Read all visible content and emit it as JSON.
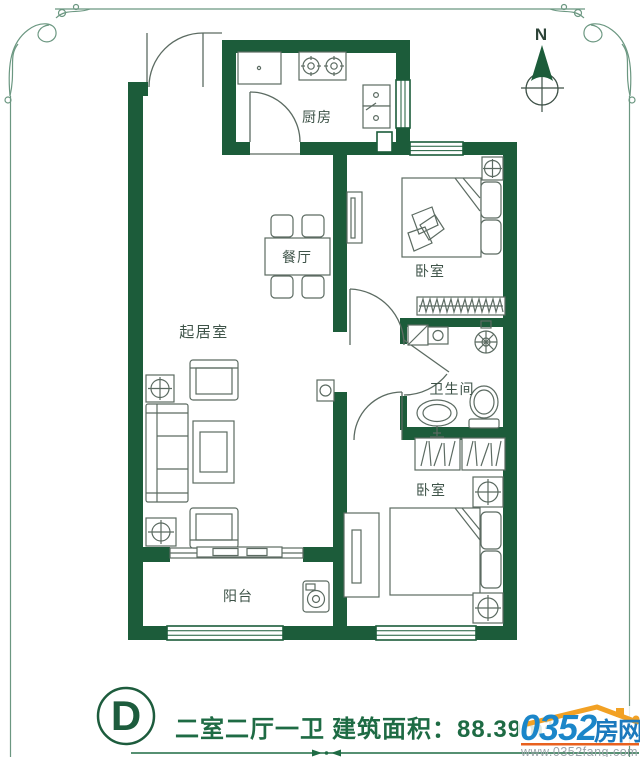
{
  "plan": {
    "rooms": {
      "kitchen": "厨房",
      "dining": "餐厅",
      "bedroom1": "卧室",
      "bathroom": "卫生间",
      "living": "起居室",
      "balcony": "阳台",
      "bedroom2": "卧室"
    },
    "compass": {
      "label": "N"
    }
  },
  "title": {
    "plan_letter": "D",
    "layout": "二室二厅一卫",
    "area": "建筑面积：88.39m²"
  },
  "watermark": {
    "brand_number": "0352",
    "brand_suffix": "房网",
    "url": "www.0352fang.com"
  },
  "colors": {
    "wall_green": "#1c5c3a",
    "title_green": "#1e6b44",
    "logo_blue": "#1b86c9",
    "logo_orange": "#f2a124",
    "logo_rule_orange": "#e8611f"
  }
}
